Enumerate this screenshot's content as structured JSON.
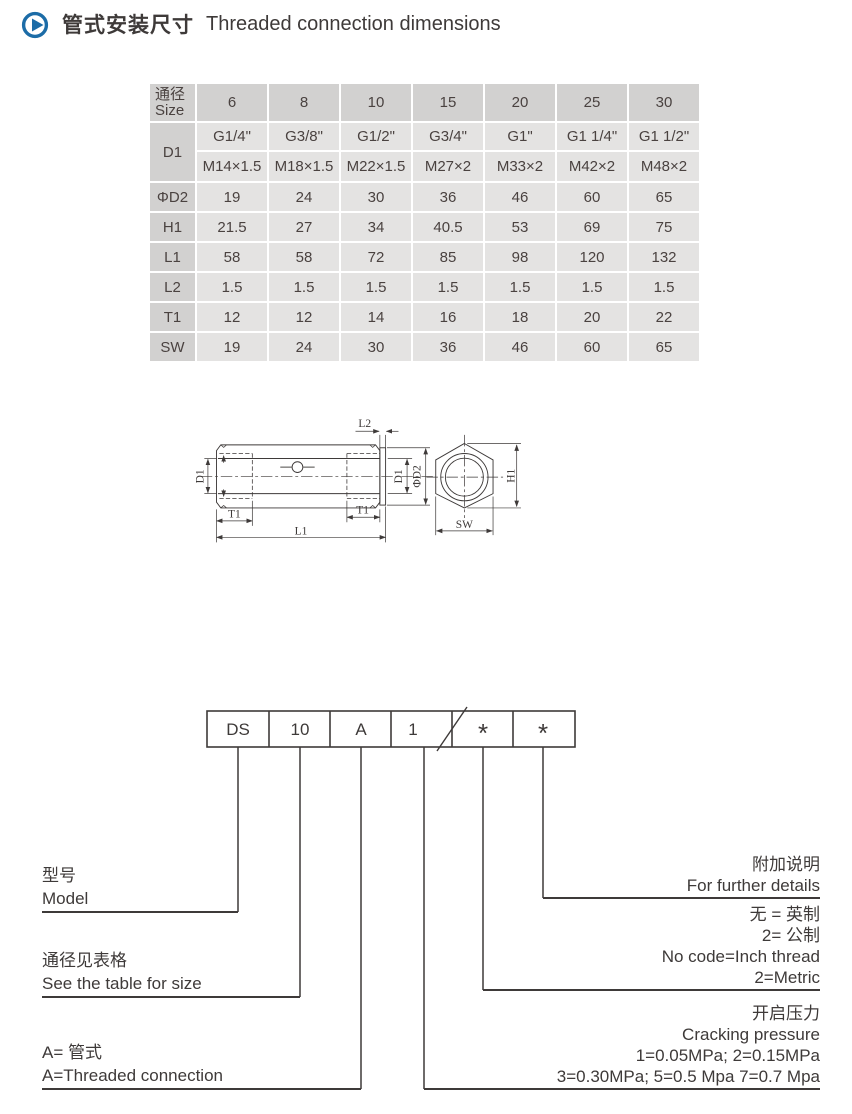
{
  "header": {
    "title_zh": "管式安装尺寸",
    "title_en": "Threaded connection dimensions"
  },
  "table": {
    "corner_zh": "通径",
    "corner_en": "Size",
    "sizes": [
      "6",
      "8",
      "10",
      "15",
      "20",
      "25",
      "30"
    ],
    "d1_label": "D1",
    "d1_g": [
      "G1/4\"",
      "G3/8\"",
      "G1/2\"",
      "G3/4\"",
      "G1\"",
      "G1 1/4\"",
      "G1 1/2\""
    ],
    "d1_m": [
      "M14×1.5",
      "M18×1.5",
      "M22×1.5",
      "M27×2",
      "M33×2",
      "M42×2",
      "M48×2"
    ],
    "rows": [
      {
        "label": "ΦD2",
        "values": [
          "19",
          "24",
          "30",
          "36",
          "46",
          "60",
          "65"
        ]
      },
      {
        "label": "H1",
        "values": [
          "21.5",
          "27",
          "34",
          "40.5",
          "53",
          "69",
          "75"
        ]
      },
      {
        "label": "L1",
        "values": [
          "58",
          "58",
          "72",
          "85",
          "98",
          "120",
          "132"
        ]
      },
      {
        "label": "L2",
        "values": [
          "1.5",
          "1.5",
          "1.5",
          "1.5",
          "1.5",
          "1.5",
          "1.5"
        ]
      },
      {
        "label": "T1",
        "values": [
          "12",
          "12",
          "14",
          "16",
          "18",
          "20",
          "22"
        ]
      },
      {
        "label": "SW",
        "values": [
          "19",
          "24",
          "30",
          "36",
          "46",
          "60",
          "65"
        ]
      }
    ]
  },
  "drawing": {
    "labels": {
      "d1_left": "D1",
      "l2": "L2",
      "d1_right": "D1",
      "phi_d2": "ΦD2",
      "t1_left": "T1",
      "t1_right": "T1",
      "l1": "L1",
      "h1": "H1",
      "sw": "SW"
    }
  },
  "model_code": {
    "cells": [
      "DS",
      "10",
      "A",
      "1",
      "*",
      "*"
    ],
    "legend": {
      "model": {
        "zh": "型号",
        "en": "Model"
      },
      "size": {
        "zh": "通径见表格",
        "en": "See the table for size"
      },
      "connection": {
        "zh": "A= 管式",
        "en": "A=Threaded connection"
      },
      "details": {
        "zh": "附加说明",
        "en": "For further details"
      },
      "thread": [
        "无 = 英制",
        "2= 公制",
        "No code=Inch thread",
        "2=Metric"
      ],
      "pressure": [
        "开启压力",
        "Cracking pressure",
        "1=0.05MPa; 2=0.15MPa",
        "3=0.30MPa; 5=0.5 Mpa 7=0.7 Mpa"
      ]
    }
  },
  "colors": {
    "accent_blue": "#1c6ca7",
    "line": "#3e3a39",
    "table_header_bg": "#d2d1d0",
    "table_cell_bg": "#e4e3e2"
  }
}
